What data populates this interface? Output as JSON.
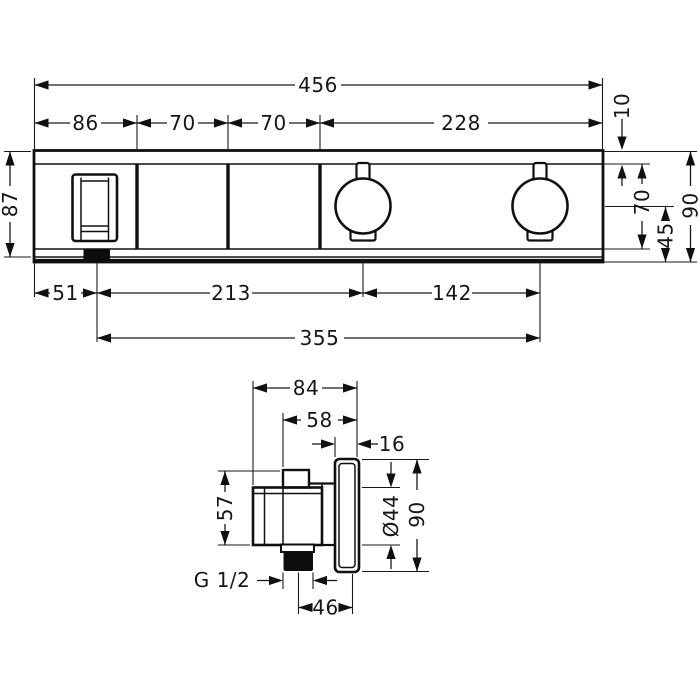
{
  "front_view": {
    "width_total": "456",
    "width_seg1": "86",
    "width_seg2": "70",
    "width_seg3": "70",
    "width_seg4": "228",
    "plate_edge_offset": "10",
    "height_body": "87",
    "height_inner": "70",
    "knob_center_to_bottom": "45",
    "height_total": "90",
    "bottom_offset": "51",
    "handle_to_knob1": "213",
    "knob1_to_knob2": "142",
    "handle_to_knob2": "355"
  },
  "side_view": {
    "depth_total": "84",
    "depth_body": "58",
    "plate_depth": "16",
    "body_height": "57",
    "knob_diameter": "Ø44",
    "plate_height": "90",
    "thread_label": "G 1/2",
    "axis_to_front": "46"
  }
}
